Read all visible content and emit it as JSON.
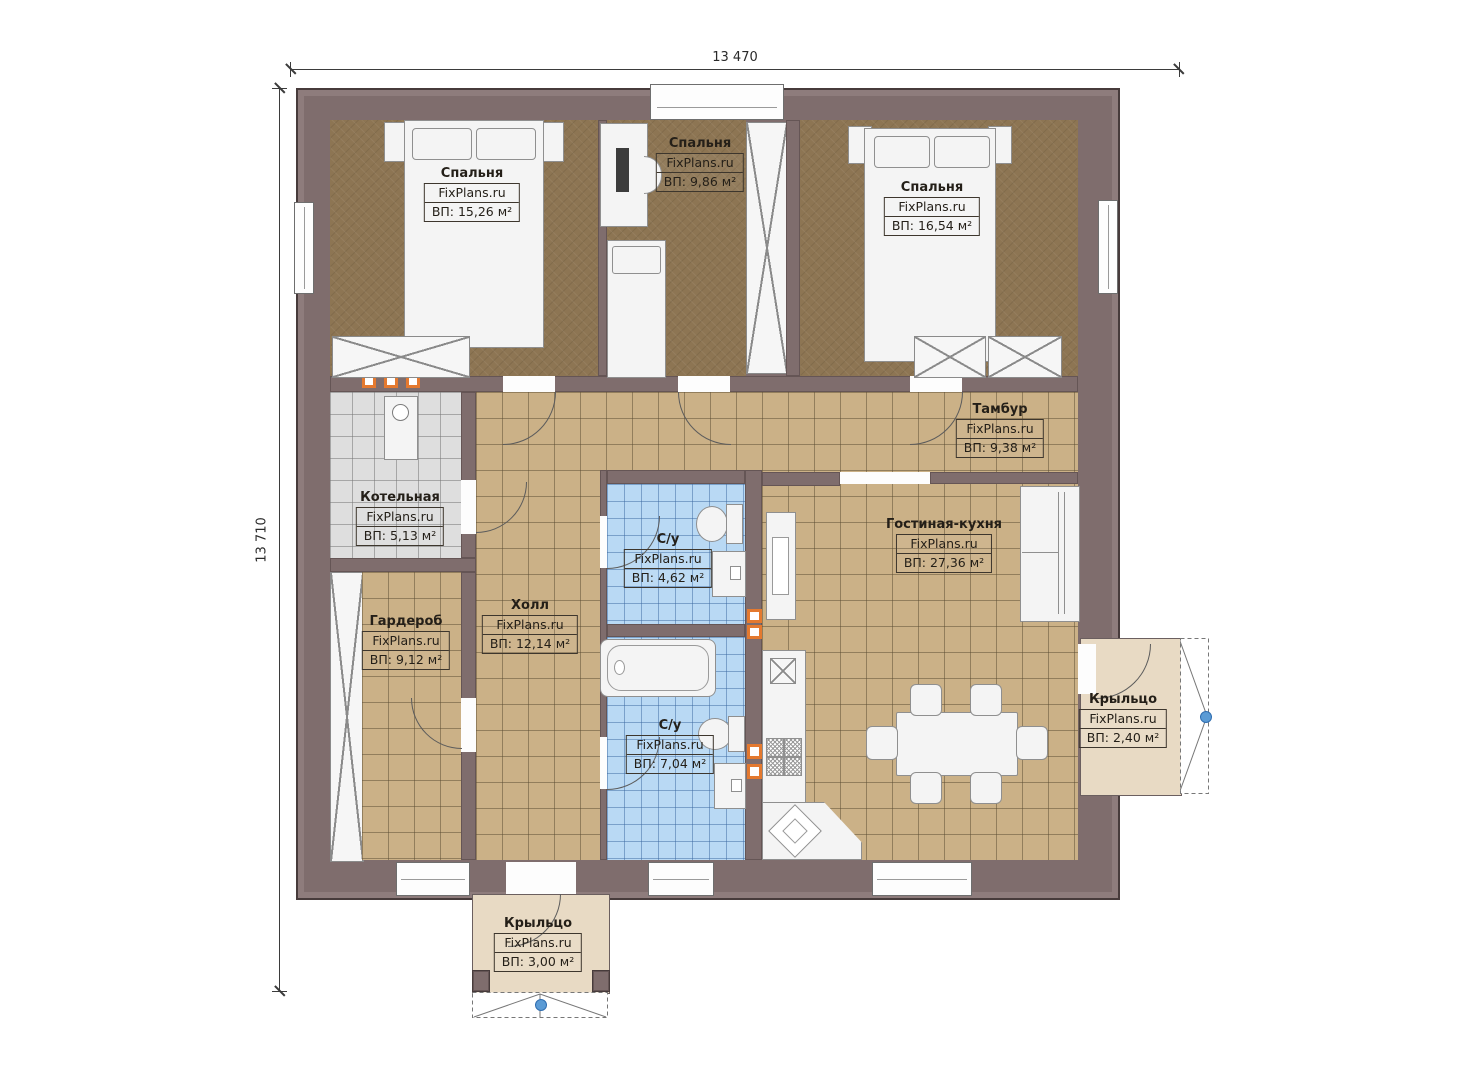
{
  "plan": {
    "title": "single-storey house floor plan",
    "brand_watermark": "FixPlans.ru",
    "dimensions": {
      "width_label": "13 470",
      "height_label": "13 710"
    },
    "rooms": [
      {
        "id": "bedroom-left",
        "name": "Спальня",
        "brand": "FixPlans.ru",
        "area": "ВП: 15,26 м²"
      },
      {
        "id": "bedroom-middle",
        "name": "Спальня",
        "brand": "FixPlans.ru",
        "area": "ВП: 9,86 м²"
      },
      {
        "id": "bedroom-right",
        "name": "Спальня",
        "brand": "FixPlans.ru",
        "area": "ВП: 16,54 м²"
      },
      {
        "id": "tambur",
        "name": "Тамбур",
        "brand": "FixPlans.ru",
        "area": "ВП: 9,38 м²"
      },
      {
        "id": "boiler-room",
        "name": "Котельная",
        "brand": "FixPlans.ru",
        "area": "ВП: 5,13 м²"
      },
      {
        "id": "living-kitchen",
        "name": "Гостиная-кухня",
        "brand": "FixPlans.ru",
        "area": "ВП: 27,36 м²"
      },
      {
        "id": "wc-top",
        "name": "С/у",
        "brand": "FixPlans.ru",
        "area": "ВП: 4,62 м²"
      },
      {
        "id": "hall",
        "name": "Холл",
        "brand": "FixPlans.ru",
        "area": "ВП: 12,14 м²"
      },
      {
        "id": "wardrobe-room",
        "name": "Гардероб",
        "brand": "FixPlans.ru",
        "area": "ВП: 9,12 м²"
      },
      {
        "id": "wc-bottom",
        "name": "С/у",
        "brand": "FixPlans.ru",
        "area": "ВП: 7,04 м²"
      },
      {
        "id": "porch-right",
        "name": "Крыльцо",
        "brand": "FixPlans.ru",
        "area": "ВП: 2,40 м²"
      },
      {
        "id": "porch-bottom",
        "name": "Крыльцо",
        "brand": "FixPlans.ru",
        "area": "ВП: 3,00 м²"
      }
    ],
    "colors": {
      "wall": "#7f6d6d",
      "wood_floor": "#8d7553",
      "tile_beige": "#cbb187",
      "tile_gray": "#dedede",
      "tile_blue": "#b9d9f4",
      "porch": "#e8dac4",
      "vent_orange": "#e4792f",
      "handle_blue": "#5b9bd5"
    }
  }
}
